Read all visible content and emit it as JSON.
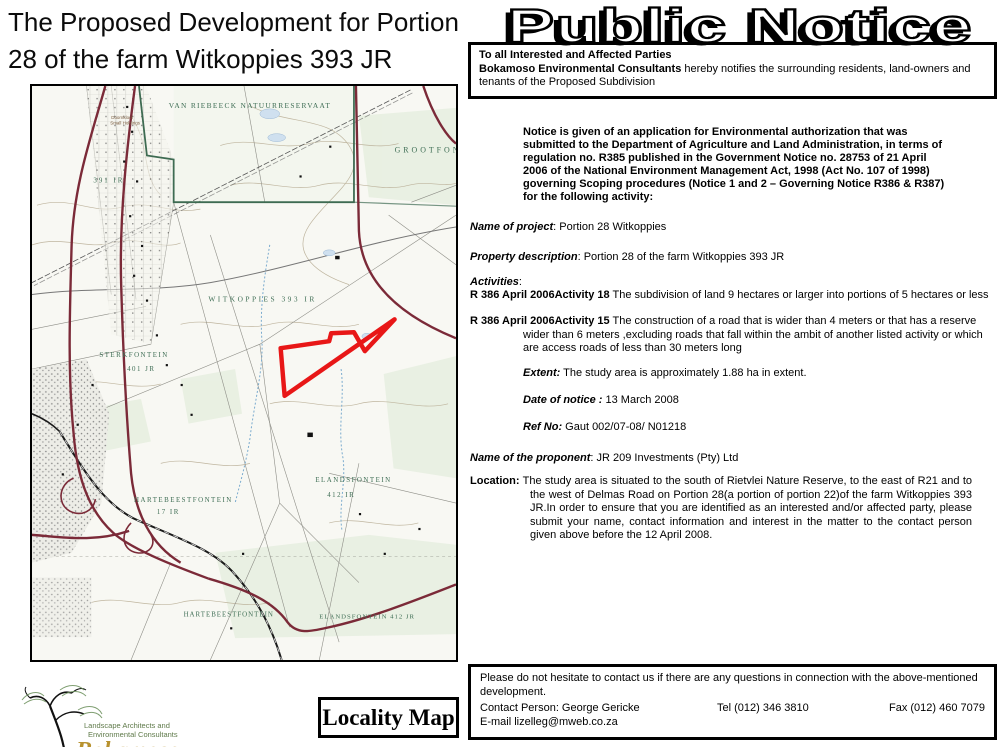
{
  "document": {
    "title_line1": "The Proposed Development for Portion",
    "title_line2": "28 of the farm Witkoppies 393 JR",
    "header_title": "Public Notice",
    "locality_map_label": "Locality Map"
  },
  "notice_box": {
    "line1": "To all Interested and Affected Parties",
    "line2_bold": "Bokamoso Environmental Consultants",
    "line2_rest": " hereby notifies the surrounding residents, land-owners and tenants of the Proposed Subdivision"
  },
  "intro_paragraph": "Notice is given of an application for Environmental authorization that was submitted to the Department of Agriculture and Land Administration, in terms of regulation no. R385 published in the Government Notice no. 28753 of 21 April 2006 of the National Environment Management Act, 1998 (Act No. 107 of 1998) governing Scoping procedures (Notice 1 and 2 – Governing Notice R386 & R387) for the following activity:",
  "fields": {
    "project_label": "Name of project",
    "project_value": ": Portion 28 Witkoppies",
    "property_label": "Property description",
    "property_value": ": Portion 28 of the farm Witkoppies 393 JR",
    "activities_label": "Activities",
    "activities_colon": ":",
    "extent_label": "Extent:",
    "extent_value": " The study area is approximately 1.88  ha in extent.",
    "date_label": "Date of notice :",
    "date_value": " 13 March 2008",
    "ref_label": "Ref No:",
    "ref_value": " Gaut 002/07-08/ N01218",
    "proponent_label": "Name of the proponent",
    "proponent_value": ": JR 209 Investments (Pty) Ltd",
    "location_label": "Location:",
    "location_value": " The study area is situated to the south of Rietvlei Nature Reserve, to the east of R21 and to the west of Delmas Road on Portion 28(a portion of portion 22)of the farm Witkoppies 393 JR.In order to ensure that you are identified as an interested and/or affected party, please submit your name, contact information and interest in the matter to the contact person given above before the 12 April 2008."
  },
  "activities": [
    {
      "label": "R 386 April 2006Activity 18",
      "text": " The subdivision of land 9 hectares or larger into portions of 5 hectares or less"
    },
    {
      "label": "R 386 April 2006Activity 15",
      "text": " The construction of a road that is wider than 4 meters or that has a reserve wider than 6 meters ,excluding roads that fall within the ambit of another listed activity or which are access roads of less than 30 meters long"
    }
  ],
  "contact_box": {
    "line1": "Please do not hesitate to contact us if there are any questions in connection  with the above-mentioned development.",
    "contact_person": "Contact Person: George Gericke",
    "tel": "Tel (012) 346 3810",
    "fax": "Fax (012) 460 7079",
    "email": "E-mail lizelleg@mweb.co.za"
  },
  "logo": {
    "tagline1": "Landscape Architects and",
    "tagline2": "Environmental Consultants",
    "name": "Bokamoso"
  },
  "map": {
    "labels": {
      "reserve": "VAN RIEBEECK NATUURRESERVAAT",
      "grootfontein": "GROOTFONTEIN",
      "witkoppies": "WITKOPPIES 393 IR",
      "farm391": "391 IR",
      "sterkfontein": "STERKFONTEIN",
      "sterkfontein_no": "401 JR",
      "hartebeest1": "HARTEBEESTFONTEIN",
      "hartebeest1_no": "17 IR",
      "elands1": "ELANDSFONTEIN",
      "elands1_no": "412 IR",
      "hartebeest2": "HARTEBEESTFONTEIN",
      "elands2": "ELANDSFONTEIN 412 JR",
      "doornkloof1": "Doornkloof",
      "doornkloof2": "Small Holdings"
    },
    "colors": {
      "study_area_outline": "#e81717",
      "main_road": "#7b2a38",
      "reserve_boundary": "#3e6b52",
      "water": "#79aace",
      "contour": "#b9ae96",
      "map_label_green": "#3f6e55"
    }
  }
}
